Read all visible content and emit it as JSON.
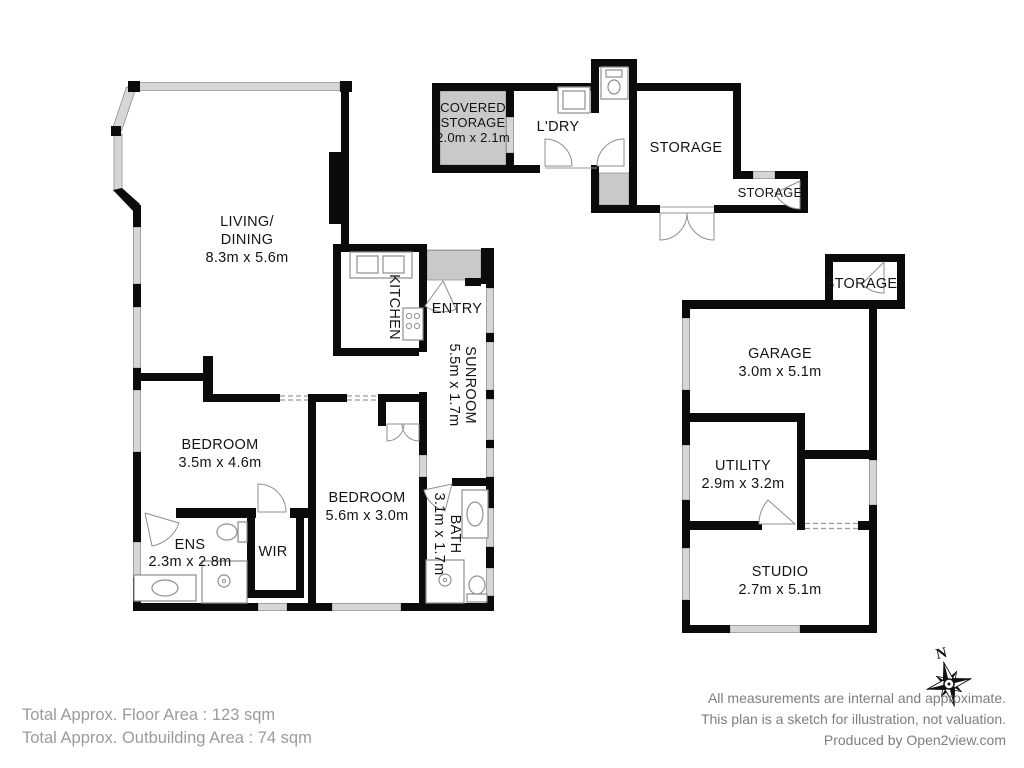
{
  "colors": {
    "wall": "#0b0b0b",
    "window_gray": "#d6d6d6",
    "shaded_area": "#c9c9c9",
    "label_text": "#141414",
    "footer_left_text": "#9b9b9b",
    "footer_right_text": "#7e7e7e"
  },
  "rooms": {
    "living": {
      "line1": "LIVING/",
      "line2": "DINING",
      "dims": "8.3m x 5.6m"
    },
    "kitchen": {
      "name": "KITCHEN"
    },
    "entry": {
      "name": "ENTRY"
    },
    "sunroom": {
      "name": "SUNROOM",
      "dims": "5.5m x 1.7m"
    },
    "bedroom1": {
      "name": "BEDROOM",
      "dims": "3.5m x 4.6m"
    },
    "bedroom2": {
      "name": "BEDROOM",
      "dims": "5.6m x 3.0m"
    },
    "bath": {
      "name": "BATH",
      "dims": "3.1m x 1.7m"
    },
    "ens": {
      "name": "ENS",
      "dims": "2.3m x 2.8m"
    },
    "wir": {
      "name": "WIR"
    }
  },
  "outbuilding_top": {
    "covered_storage": {
      "line1": "COVERED",
      "line2": "STORAGE",
      "dims": "2.0m x 2.1m"
    },
    "laundry": {
      "name": "L'DRY"
    },
    "storage_main": {
      "name": "STORAGE"
    },
    "storage_small": {
      "name": "STORAGE"
    }
  },
  "outbuilding_right": {
    "storage_top": {
      "name": "STORAGE"
    },
    "garage": {
      "name": "GARAGE",
      "dims": "3.0m x 5.1m"
    },
    "utility": {
      "name": "UTILITY",
      "dims": "2.9m x 3.2m"
    },
    "studio": {
      "name": "STUDIO",
      "dims": "2.7m x 5.1m"
    }
  },
  "compass": {
    "north_label": "N"
  },
  "footer": {
    "left_line1": "Total Approx. Floor Area : 123 sqm",
    "left_line2": "Total Approx. Outbuilding Area : 74 sqm",
    "right_line1": "All measurements are internal and approximate.",
    "right_line2": "This plan is a sketch for illustration, not valuation.",
    "right_line3": "Produced by Open2view.com"
  }
}
